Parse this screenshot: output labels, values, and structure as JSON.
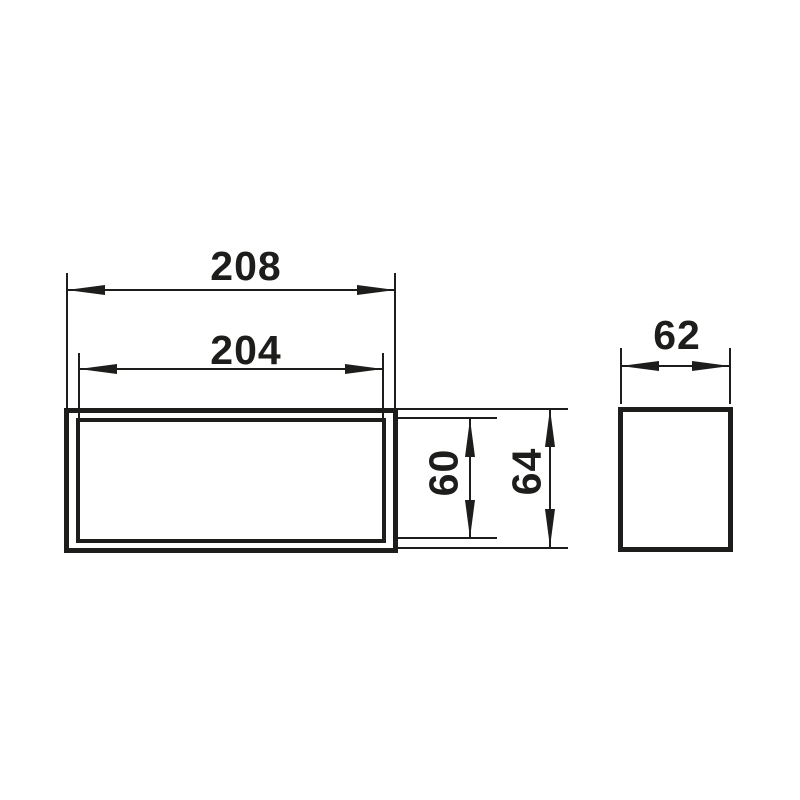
{
  "drawing": {
    "type": "technical-dimension-drawing",
    "colors": {
      "line": "#1d1d1b",
      "background": "#ffffff"
    },
    "views": {
      "front": {
        "description": "front view, double-walled rectangular duct",
        "dims": {
          "outer_width": "208",
          "inner_width": "204",
          "inner_height": "60",
          "outer_height": "64"
        }
      },
      "side": {
        "description": "side view, single rectangle",
        "dims": {
          "depth": "62"
        }
      }
    }
  }
}
